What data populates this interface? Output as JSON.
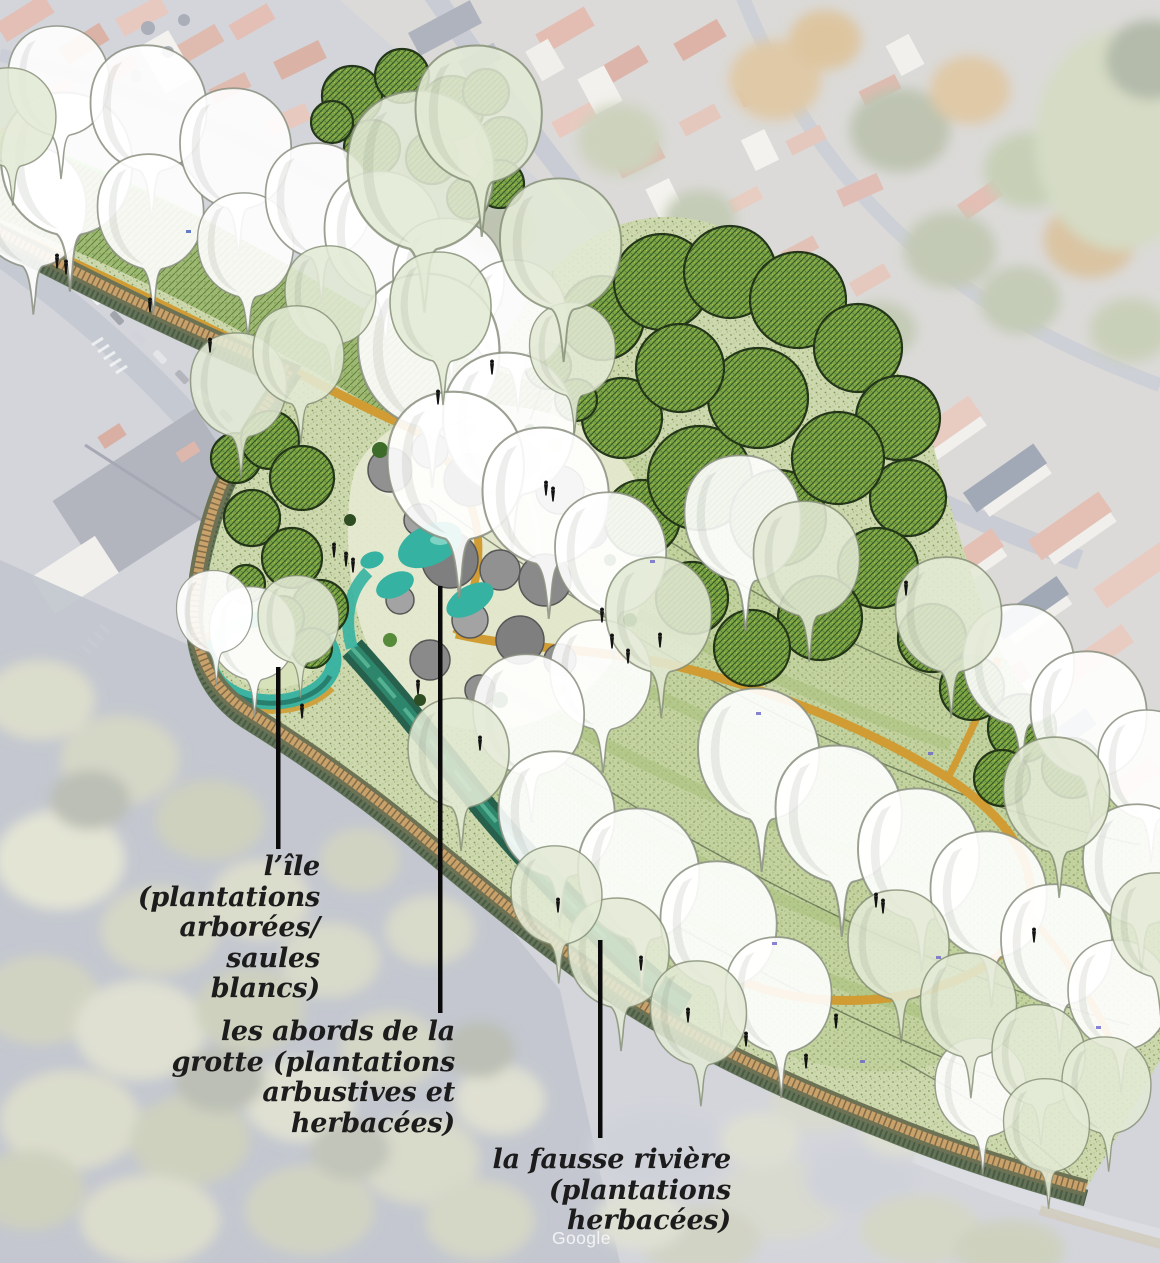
{
  "scene": {
    "description": "Landscape masterplan rendering photomontaged over an aerial town view",
    "watermark": "Google"
  },
  "annotations": {
    "text_color": "#1d1c1c",
    "leader_color": "#0a0a0a",
    "labels": [
      {
        "id": "ile",
        "text": "l’île\n(plantations\narborées/\nsaules\nblancs)"
      },
      {
        "id": "grotte",
        "text": "les abords de la\ngrotte (plantations\narbustives et\nherbacées)"
      },
      {
        "id": "fausse_riviere",
        "text": "la fausse rivière\n(plantations\nherbacées)"
      }
    ]
  },
  "palette": {
    "path_ochre": "#d09c33",
    "water_teal": "#35b2a1",
    "river_dark": "#1e5b48",
    "park_light": "#cdd8ae",
    "tree_hatch": "#79a544",
    "rock_gray": "#8d8d8d",
    "photo_base": "#b4b7c2"
  }
}
